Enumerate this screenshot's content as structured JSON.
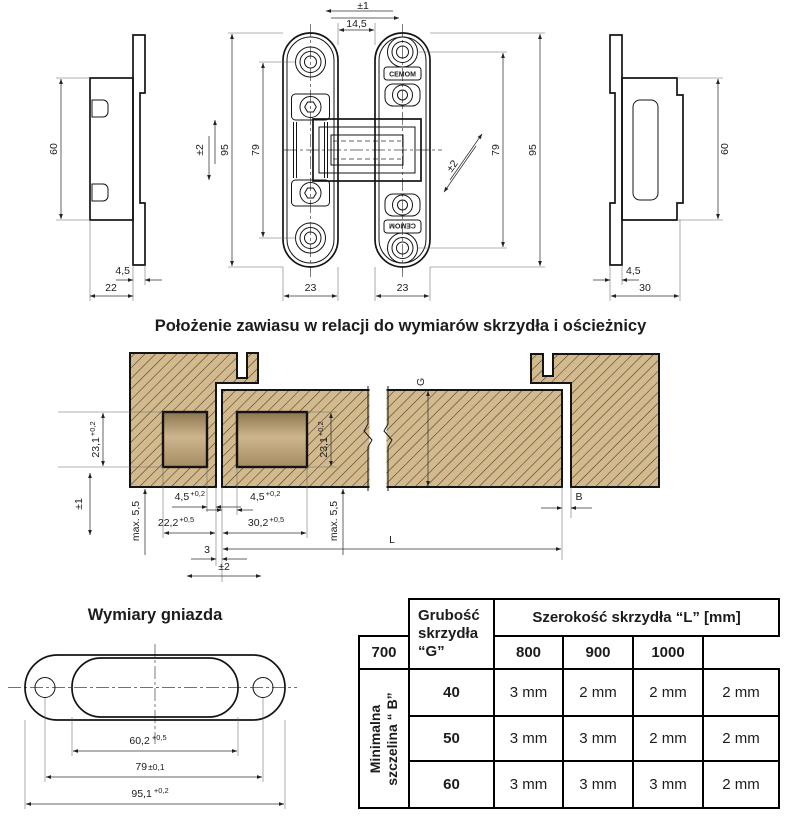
{
  "colors": {
    "line": "#141414",
    "dim_line": "#333333",
    "wood_fill": "#d2ba8e",
    "wood_hatch": "#463a22",
    "pocket_gradient": [
      "#8d7550",
      "#cdb58d",
      "#a58c63"
    ]
  },
  "views": {
    "left_profile": {
      "height": "60",
      "thickness": "4,5",
      "width": "22"
    },
    "front": {
      "play_horizontal": "±1",
      "gap": "14,5",
      "brand": "CEMOM",
      "play_vertical": "±2",
      "body_height_left": "95",
      "hole_spacing_left": "79",
      "play_diagonal": "±2",
      "hole_spacing_right": "79",
      "body_height_right": "95",
      "plate_width_left": "23",
      "plate_width_right": "23"
    },
    "right_profile": {
      "height": "60",
      "thickness": "4,5",
      "width": "30"
    }
  },
  "position_section": {
    "title": "Położenie zawiasu w relacji do wymiarów skrzydła i ościeżnicy",
    "dims": {
      "play_vertical": "±1",
      "pocket_height_frame": {
        "v": "23,1",
        "t": "+0,2"
      },
      "max_frame": "max. 5,5",
      "inset_frame": {
        "v": "4,5",
        "t": "+0,2"
      },
      "depth_frame": {
        "v": "22,2",
        "t": "+0,5"
      },
      "gap": "3",
      "play_horizontal": "±2",
      "inset_leaf": {
        "v": "4,5",
        "t": "+0,2"
      },
      "depth_leaf": {
        "v": "30,2",
        "t": "+0,5"
      },
      "pocket_height_leaf": {
        "v": "23,1",
        "t": "+0,2"
      },
      "max_leaf": "max. 5,5",
      "leaf_thickness": "G",
      "min_gap": "B",
      "leaf_width": "L"
    }
  },
  "socket_section": {
    "title": "Wymiary gniazda",
    "dims": {
      "socket_width": {
        "v": "60,2",
        "t": "+0,5"
      },
      "hole_spacing": {
        "v": "79",
        "t": "±0,1"
      },
      "outer_length": {
        "v": "95,1",
        "t": "+0,2"
      }
    }
  },
  "table": {
    "thickness_header": "Grubość skrzydła “G”",
    "width_header": "Szerokość skrzydła “L” [mm]",
    "width_columns": [
      "700",
      "800",
      "900",
      "1000"
    ],
    "row_header_line1": "Minimalna",
    "row_header_line2": "szczelina “ B”",
    "rows": [
      {
        "thickness": "40",
        "gaps": [
          "3 mm",
          "2 mm",
          "2 mm",
          "2 mm"
        ]
      },
      {
        "thickness": "50",
        "gaps": [
          "3 mm",
          "3 mm",
          "2 mm",
          "2 mm"
        ]
      },
      {
        "thickness": "60",
        "gaps": [
          "3 mm",
          "3 mm",
          "3 mm",
          "2 mm"
        ]
      }
    ]
  }
}
